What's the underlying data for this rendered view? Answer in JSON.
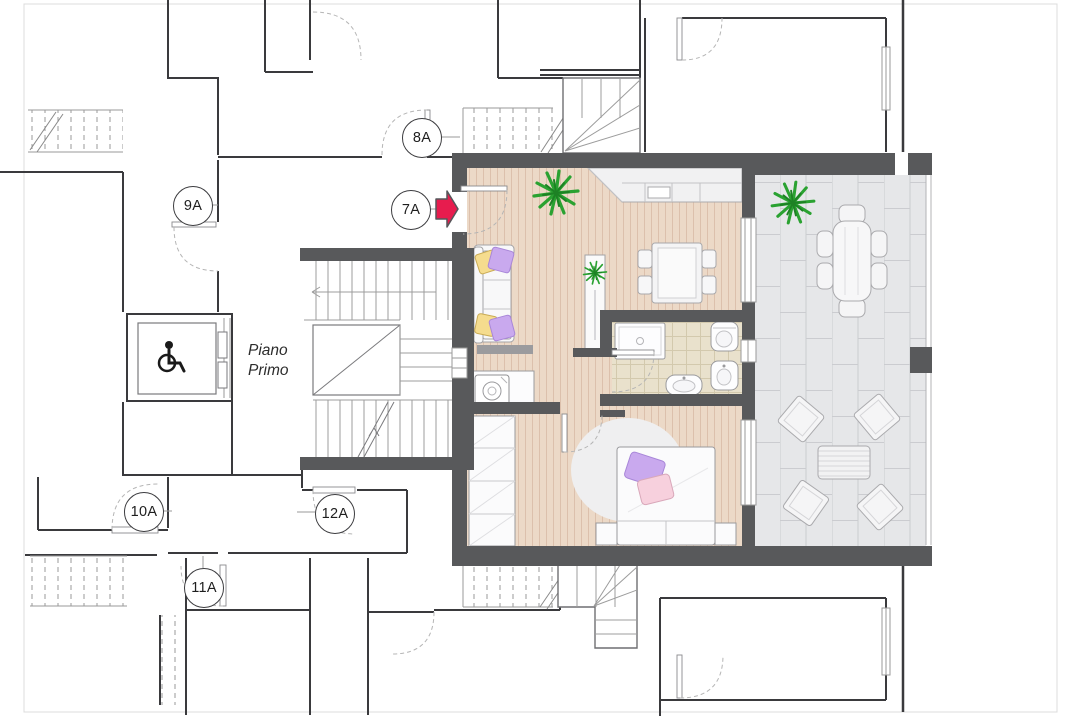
{
  "title": "Piano Primo floor plan",
  "floor_label": {
    "line1": "Piano",
    "line2": "Primo"
  },
  "unit_labels": [
    {
      "text": "8A"
    },
    {
      "text": "9A"
    },
    {
      "text": "7A"
    },
    {
      "text": "10A"
    },
    {
      "text": "12A"
    },
    {
      "text": "11A"
    }
  ],
  "colors": {
    "wall_dark": "#58595b",
    "thin_wall": "#3a3a3d",
    "wood_floor": "#ecd9c7",
    "wood_stripe": "#dcc0ac",
    "bath_tile": "#e9e1cc",
    "terrace_tile": "#e6e7e9",
    "terrace_joint": "#cbccd0",
    "entrance_arrow": "#e71c4e",
    "plant_green": "#2aa231",
    "pillow_purple": "#c9a9ee",
    "pillow_yellow": "#f5dc8e",
    "pillow_pink": "#f7d0dd",
    "rug": "#efeff0"
  },
  "icons": [
    {
      "name": "wheelchair-icon"
    },
    {
      "name": "entrance-arrow-icon"
    },
    {
      "name": "plant-icon"
    }
  ]
}
